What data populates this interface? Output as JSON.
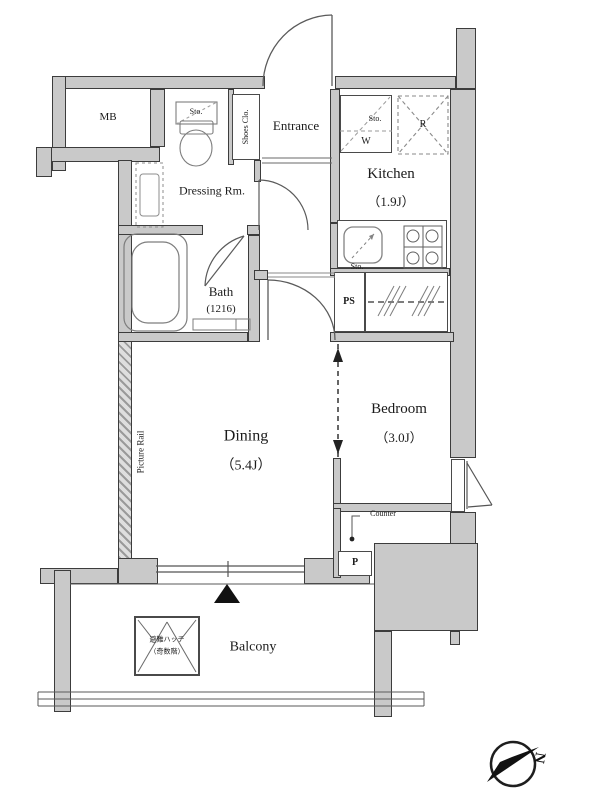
{
  "plan": {
    "mb_label": "MB",
    "dressing_label": "Dressing Rm.",
    "toilet_storage_label": "Sto.",
    "shoes_closet_label": "Shoes Clo.",
    "entrance_label": "Entrance",
    "kitchen_label": "Kitchen",
    "kitchen_size": "（1.9J）",
    "washer_storage_label": "Sto.",
    "washer_label": "W",
    "fridge_label": "R",
    "sink_storage_label": "Sto.",
    "bath_label": "Bath",
    "bath_size": "(1216)",
    "ps_label": "PS",
    "dining_label": "Dining",
    "dining_size": "（5.4J）",
    "picture_rail_label": "Picture Rail",
    "bedroom_label": "Bedroom",
    "bedroom_size": "（3.0J）",
    "counter_label": "Counter",
    "porch_label": "P",
    "balcony_label": "Balcony",
    "hatch_label_1": "避難ハッチ",
    "hatch_label_2": "（奇数階）",
    "compass_north_label": "N"
  },
  "colors": {
    "wall_fill": "#c9c9c9",
    "wall_line": "#3c3c3c",
    "fixture_line": "#7d7d7d",
    "text": "#1b1b1b"
  }
}
